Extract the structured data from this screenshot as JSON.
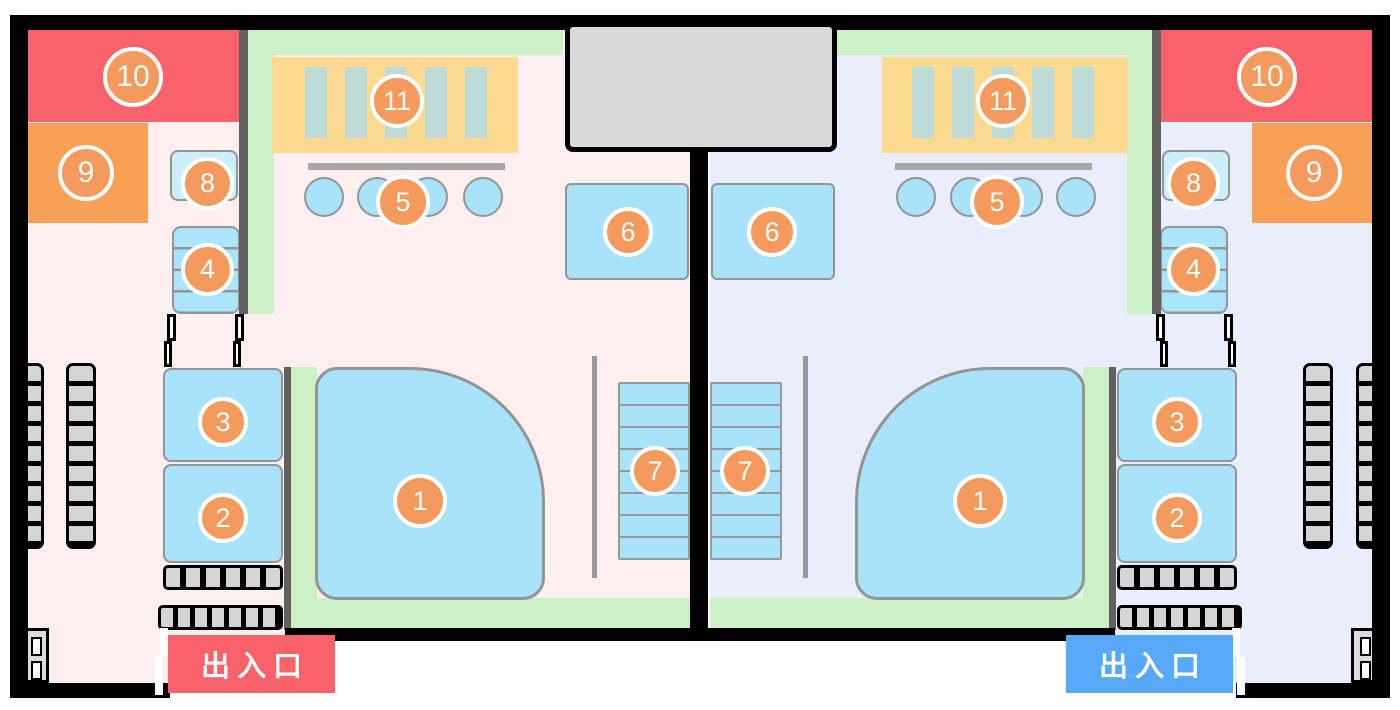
{
  "markers": {
    "m1": "1",
    "m2": "2",
    "m3": "3",
    "m4": "4",
    "m5": "5",
    "m6": "6",
    "m7": "7",
    "m8": "8",
    "m9": "9",
    "m10": "10",
    "m11": "11"
  },
  "entrances": {
    "left": "出入口",
    "right": "出入口"
  },
  "colors": {
    "wall_black": "#000000",
    "partition_gray": "#606060",
    "floor_left_pink": "#fdeff0",
    "floor_right_lavender": "#e8eefb",
    "deck_green": "#cdf0c7",
    "water_blue": "#a9e3fa",
    "shelf_light_blue": "#cdeefb",
    "sauna_yellow": "#fbd98f",
    "sauna_stripe_teal": "#bedbd8",
    "room_red": "#f9626b",
    "room_orange": "#f8a156",
    "badge_orange": "#f49a5c",
    "entrance_left_red": "#f9626b",
    "entrance_right_blue": "#58a8f8",
    "locker_gray": "#d5d5d5",
    "roof_gray": "#d8d8d8"
  }
}
